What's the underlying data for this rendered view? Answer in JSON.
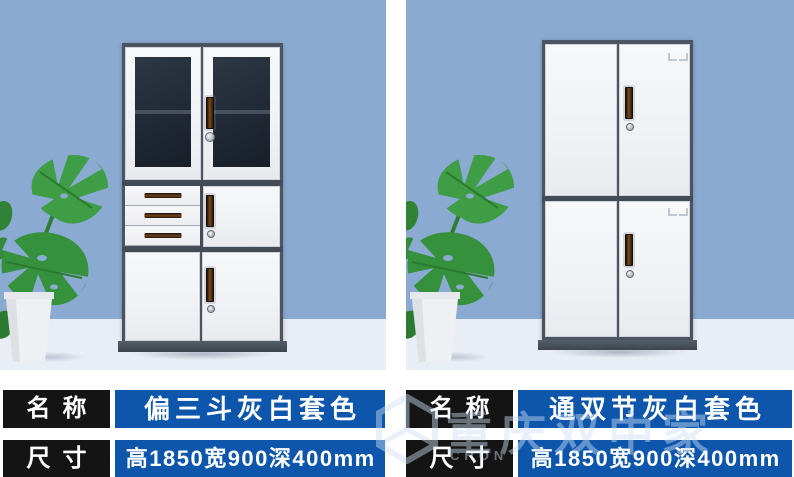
{
  "panels": [
    {
      "rows": [
        {
          "label": "名称",
          "value": "偏三斗灰白套色"
        },
        {
          "label": "尺寸",
          "value": "高1850宽900深400mm"
        }
      ]
    },
    {
      "rows": [
        {
          "label": "名称",
          "value": "通双节灰白套色"
        },
        {
          "label": "尺寸",
          "value": "高1850宽900深400mm"
        }
      ]
    }
  ],
  "watermark": {
    "cn": "重庆双中家具",
    "en": "CHON"
  },
  "colors": {
    "background_blue": "#8aaad1",
    "floor": "#e9eef6",
    "label_black": "#141414",
    "value_blue": "#0e56ac",
    "cabinet_frame": "#4b5460",
    "door_white": "#f2f3f6",
    "glass_dark": "#202935",
    "handle_brown": "#6e431c",
    "leaf_green": "#3b9a42"
  }
}
